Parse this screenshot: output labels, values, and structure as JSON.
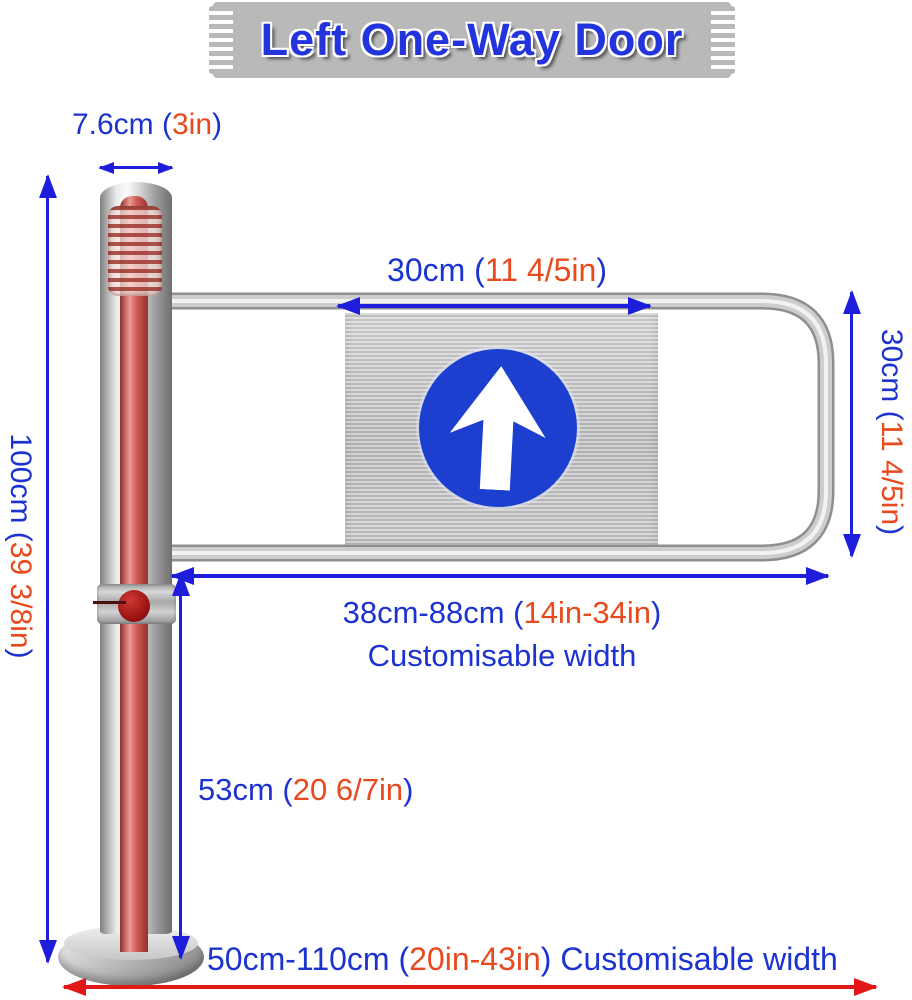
{
  "banner": {
    "title": "Left One-Way Door"
  },
  "sign": {
    "icon": "up-arrow"
  },
  "labels": {
    "post_diameter": {
      "metric": "7.6cm (",
      "imperial": "3in",
      "close": ")"
    },
    "post_height": {
      "metric": "100cm (",
      "imperial": "39 3/8in",
      "close": ")"
    },
    "panel_width": {
      "metric": "30cm (",
      "imperial": "11 4/5in",
      "close": ")"
    },
    "arm_height": {
      "metric": "30cm (",
      "imperial": "11 4/5in",
      "close": ")"
    },
    "arm_length": {
      "metric": "38cm-88cm (",
      "imperial": "14in-34in",
      "close": ")"
    },
    "arm_length_note": "Customisable width",
    "lower_clearance": {
      "metric": "53cm (",
      "imperial": "20 6/7in",
      "close": ")"
    },
    "total_width": {
      "metric": "50cm-110cm (",
      "imperial": "20in-43in",
      "close": ") Customisable width"
    }
  },
  "colors": {
    "text_blue": "#1c33cf",
    "inch_orange": "#e8491d",
    "arrow_blue": "#1d1ddb",
    "arrow_red": "#e21717",
    "title_blue": "#2334dd",
    "banner_gray": "#b9b9b9",
    "sign_blue": "#1c3fd0"
  }
}
